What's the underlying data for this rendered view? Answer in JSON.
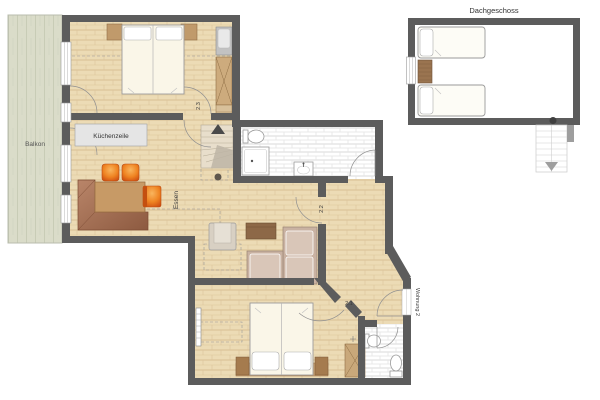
{
  "plan": {
    "attic_title": "Dachgeschoss",
    "balcony_label": "Balkon",
    "kitchen_unit_label": "Küchenzeile",
    "dining_label": "Essen",
    "apartment_label": "Wohnung 2",
    "rooms": {
      "bedroom_top_code": "2.3",
      "living_code": "2.2",
      "bedroom_bottom_code": "2.1"
    },
    "colors": {
      "wall": "#5c5c5c",
      "floor_wood": "#ecdbb5",
      "balcony_deck": "#dadcc9",
      "bathroom_tile": "#ffffff",
      "accent_orange": "#ef8422",
      "furniture_brown": "#a97457",
      "label_text": "#3c3c3c"
    }
  }
}
